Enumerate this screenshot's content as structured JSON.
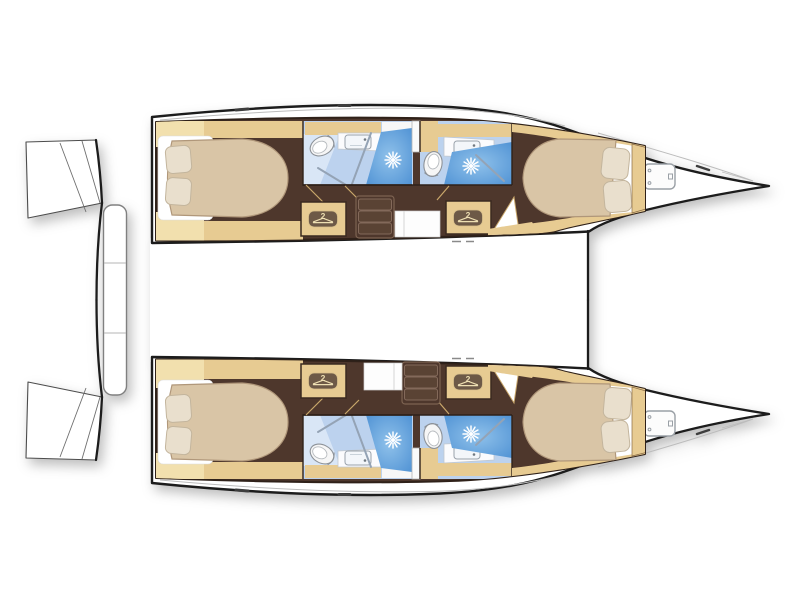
{
  "page": {
    "background": "#ffffff",
    "description": "Top-down interior layout plan of a sailing catamaran, bows pointing right"
  },
  "wardrobe": {
    "capacity_label": "2"
  },
  "vessel": {
    "type": "catamaran",
    "view": "hull-level deck plan",
    "orientation": "bows to the right, sterns to the left",
    "hulls": [
      {
        "name": "upper hull",
        "compartments": [
          "aft double cabin with two pillows",
          "aft head with WC, sink and shower",
          "hanging wardrobe",
          "companionway steps",
          "forward head with WC, sink and shower",
          "forward double cabin with two pillows",
          "bow locker with deck hatch"
        ]
      },
      {
        "name": "lower hull",
        "compartments": [
          "aft double cabin with two pillows",
          "aft head with WC, sink and shower",
          "hanging wardrobe",
          "companionway steps",
          "forward head with WC, sink and shower",
          "forward double cabin with two pillows",
          "bow locker with deck hatch"
        ]
      }
    ],
    "between_hulls": [
      "aft crossbeam with boarding platform",
      "bridge deck"
    ]
  },
  "colors": {
    "hull_outline": "#1c1c1c",
    "deck_line": "#bcbcbc",
    "floor_brown": "#4e372c",
    "floor_stroke": "#2f2119",
    "joinery_tan": "#e7cb92",
    "joinery_tan_light": "#f2e0ae",
    "mattress": "#d9c5a6",
    "mattress_stroke": "#b0977a",
    "linen_white": "#ffffff",
    "pillow": "#e9dfcd",
    "pillow_stroke": "#c3b59d",
    "bath_floor": "#bcd2ee",
    "bath_floor_light": "#d9e6f6",
    "shower_blue": "#5596d6",
    "shower_blue_light": "#8fc1ea",
    "fixture_white": "#f6f6f6",
    "fixture_stroke": "#8d9298",
    "glass_line": "#94a3b5",
    "hanger_pill": "#6d5947",
    "hanger_glyph": "#eedfb2",
    "door_swing": "#c9a76b",
    "white_floor": "#fdfdfd",
    "step_face": "#5a4334",
    "step_edge": "#83695a"
  }
}
